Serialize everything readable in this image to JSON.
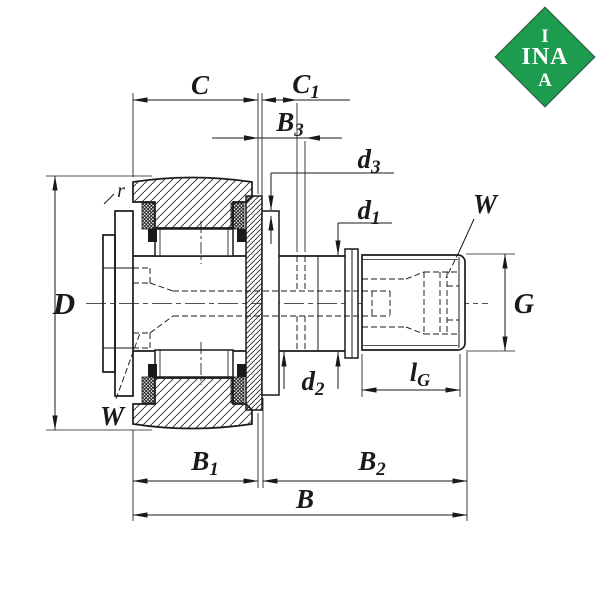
{
  "logo": {
    "line1": "I",
    "line2": "INA",
    "line3": "A",
    "green": "#1d9c4f",
    "text_color": "#ffffff"
  },
  "labels": {
    "C": "C",
    "C1": {
      "base": "C",
      "sub": "1"
    },
    "B3": {
      "base": "B",
      "sub": "3"
    },
    "d3": {
      "base": "d",
      "sub": "3"
    },
    "d1": {
      "base": "d",
      "sub": "1"
    },
    "d2": {
      "base": "d",
      "sub": "2"
    },
    "D": "D",
    "G": "G",
    "lG": {
      "base": "l",
      "sub": "G"
    },
    "B1": {
      "base": "B",
      "sub": "1"
    },
    "B2": {
      "base": "B",
      "sub": "2"
    },
    "B": "B",
    "W_top": "W",
    "W_bottom": "W",
    "r": "r"
  },
  "colors": {
    "line": "#1a1a1a",
    "background": "#ffffff"
  }
}
